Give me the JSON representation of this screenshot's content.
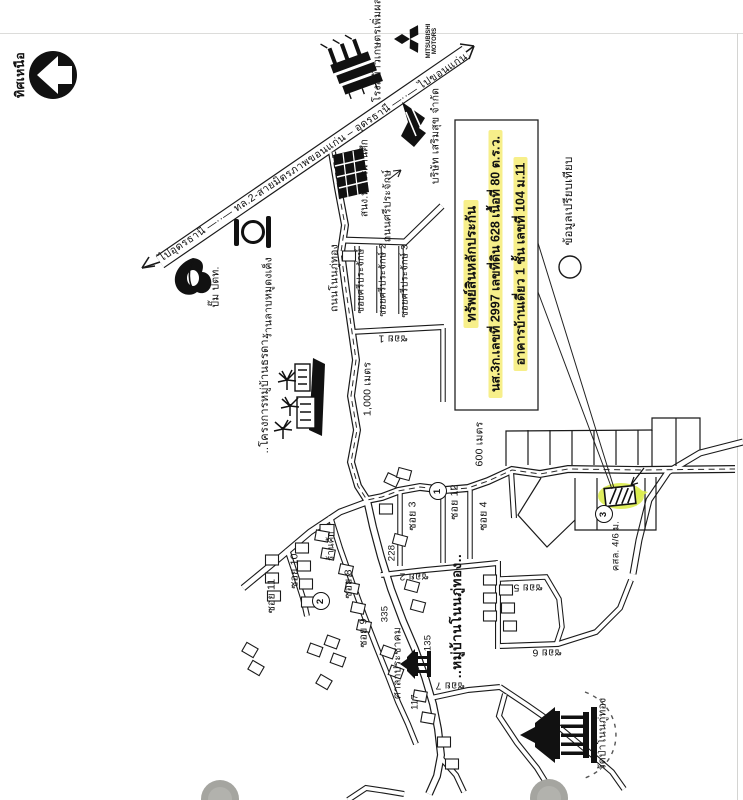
{
  "labels": {
    "north": "ทิศเหนือ",
    "highway": "ไปอุดรธานี —··— ทล.2-สายมิตรภาพขอนแก่น – อุดรธานี —··— ไปขอนแก่น",
    "ricemill": "โรงสีข้าวเกษตรเพิ่มผล",
    "mitsubishi1": "MITSUBISHI",
    "mitsubishi2": "MOTORS",
    "sermsuk": "บริษัท เสริมสุข จำกัด",
    "veterans": "สนง.ทหารผ่านศึก",
    "sriprajak_rd": "ถนนศรีประจักษ์",
    "ptt": "ปั๊ม ปตท.",
    "larb": "ร้านลาบหมูดงเค็ง",
    "nonphuthong_rd": "ถนนโนนภู่ทอง",
    "soi_sri_1": "ซอยศรีประจักษ์",
    "soi_sri_2": "ซอยศรีประจักษ์ 2",
    "soi_sri_3": "ซอยศรีประจักษ์ 3",
    "soi1": "ซอย 1",
    "soi2": "ซอย 2",
    "soi3": "ซอย 3",
    "soi4": "ซอย 4",
    "soi5": "ซอย 5",
    "soi6": "ซอย 6",
    "soi7": "ซอย 7",
    "soi8": "ซอย 8",
    "soi9": "ซอย 9",
    "soi10": "ซอย 10",
    "soi11": "ซอย 11",
    "soi12": "ซอย 12",
    "m1000": "1,000 เมตร",
    "m600": "600 เมตร",
    "project": "..โครงการหมู่บ้านธรดา..",
    "compare": "ข้อมูลเปรียบเทียบ",
    "shop": "ร้านค้า",
    "n228": "228",
    "n335": "335",
    "n117": "117",
    "n135": "135",
    "sala": "ศาลาประชาคม",
    "village": "..หมู่บ้านโนนภู่ทอง..",
    "wat": "วัดป่าโนนภู่ทอง",
    "kslm": "คสล. 4/6 ม.",
    "c1": "1",
    "c2": "2",
    "c3": "3"
  },
  "subject": {
    "line1": "ทรัพย์สินหลักประกัน",
    "line2": "นส.3ก.เลขที่ 2997 เลขที่ดิน 628 เนื้อที่ 80 ต.ร.ว.",
    "line3": "อาคารบ้านเดี่ยว 1 ชั้น เลขที่ 104 ม.11"
  },
  "colors": {
    "ink": "#1a1a1a",
    "text_highlight": "#f7ef8a",
    "plot_highlight": "#dcec4e"
  }
}
